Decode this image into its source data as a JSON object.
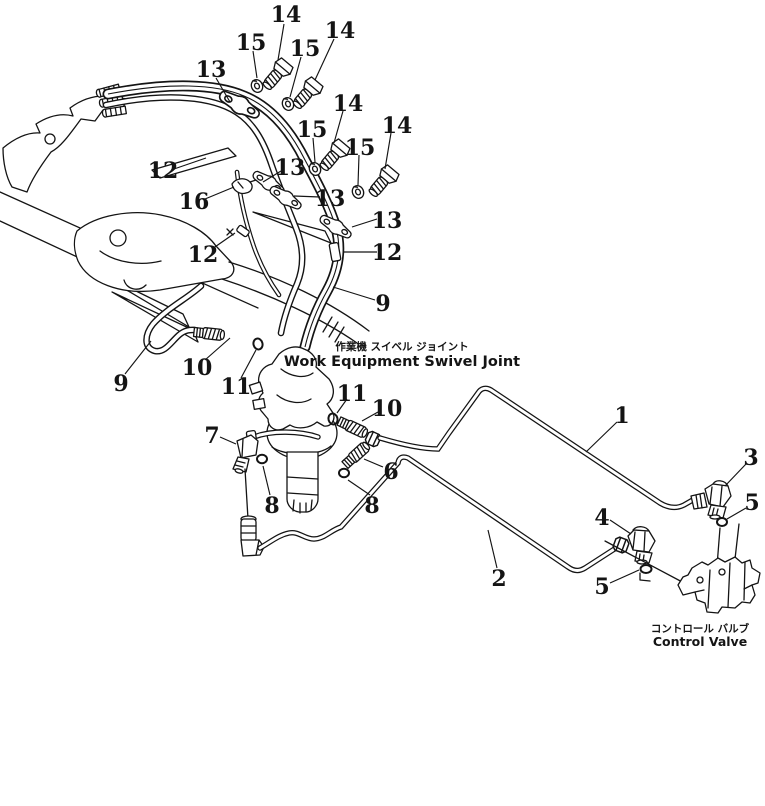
{
  "figure": {
    "kind": "parts-diagram",
    "ink": "#141414",
    "paper": "#ffffff",
    "swivel_caption": {
      "jp": "作業機 スイベル ジョイント",
      "en": "Work Equipment Swivel Joint"
    },
    "valve_caption": {
      "jp": "コントロール バルブ",
      "en": "Control Valve"
    }
  },
  "callouts": [
    {
      "t": "14",
      "x": 286,
      "y": 14,
      "l": [
        284,
        24,
        278,
        60
      ]
    },
    {
      "t": "15",
      "x": 251,
      "y": 42,
      "l": [
        253,
        51,
        257,
        78
      ]
    },
    {
      "t": "15",
      "x": 305,
      "y": 48,
      "l": [
        301,
        57,
        290,
        97
      ]
    },
    {
      "t": "14",
      "x": 340,
      "y": 30,
      "l": [
        334,
        39,
        315,
        80
      ]
    },
    {
      "t": "13",
      "x": 211,
      "y": 69,
      "l": [
        216,
        78,
        230,
        102
      ]
    },
    {
      "t": "14",
      "x": 348,
      "y": 103,
      "l": [
        343,
        111,
        334,
        143
      ]
    },
    {
      "t": "15",
      "x": 312,
      "y": 129,
      "l": [
        313,
        138,
        315,
        162
      ]
    },
    {
      "t": "13",
      "x": 290,
      "y": 167,
      "l": [
        281,
        171,
        263,
        182
      ]
    },
    {
      "t": "15",
      "x": 360,
      "y": 147,
      "l": [
        359,
        155,
        358,
        185
      ]
    },
    {
      "t": "14",
      "x": 397,
      "y": 125,
      "l": [
        391,
        133,
        385,
        169
      ]
    },
    {
      "t": "12",
      "x": 163,
      "y": 170,
      "l": [
        174,
        169,
        206,
        158
      ]
    },
    {
      "t": "16",
      "x": 194,
      "y": 201,
      "l": [
        205,
        199,
        234,
        187
      ]
    },
    {
      "t": "13",
      "x": 330,
      "y": 198,
      "l": [
        320,
        197,
        294,
        196
      ]
    },
    {
      "t": "12",
      "x": 203,
      "y": 254,
      "l": [
        212,
        249,
        235,
        233
      ]
    },
    {
      "t": "13",
      "x": 387,
      "y": 220,
      "l": [
        377,
        219,
        352,
        227
      ]
    },
    {
      "t": "12",
      "x": 387,
      "y": 252,
      "l": [
        377,
        252,
        344,
        252
      ]
    },
    {
      "t": "9",
      "x": 383,
      "y": 303,
      "l": [
        375,
        300,
        333,
        287
      ]
    },
    {
      "t": "9",
      "x": 121,
      "y": 383,
      "l": [
        125,
        374,
        151,
        341
      ]
    },
    {
      "t": "10",
      "x": 197,
      "y": 367,
      "l": [
        205,
        360,
        230,
        338
      ]
    },
    {
      "t": "11",
      "x": 236,
      "y": 386,
      "l": [
        241,
        378,
        256,
        350
      ]
    },
    {
      "t": "11",
      "x": 352,
      "y": 393,
      "l": [
        347,
        399,
        337,
        413
      ]
    },
    {
      "t": "10",
      "x": 387,
      "y": 408,
      "l": [
        378,
        412,
        362,
        421
      ]
    },
    {
      "t": "7",
      "x": 212,
      "y": 435,
      "l": [
        220,
        437,
        236,
        444
      ]
    },
    {
      "t": "8",
      "x": 272,
      "y": 505,
      "l": [
        270,
        495,
        263,
        466
      ]
    },
    {
      "t": "8",
      "x": 372,
      "y": 505,
      "l": [
        370,
        495,
        348,
        480
      ]
    },
    {
      "t": "6",
      "x": 391,
      "y": 471,
      "l": [
        383,
        467,
        364,
        459
      ]
    },
    {
      "t": "1",
      "x": 622,
      "y": 415,
      "l": [
        617,
        422,
        586,
        452
      ]
    },
    {
      "t": "2",
      "x": 499,
      "y": 578,
      "l": [
        497,
        568,
        488,
        530
      ]
    },
    {
      "t": "3",
      "x": 751,
      "y": 457,
      "l": [
        746,
        464,
        725,
        486
      ]
    },
    {
      "t": "5",
      "x": 752,
      "y": 502,
      "l": [
        746,
        508,
        727,
        519
      ]
    },
    {
      "t": "4",
      "x": 602,
      "y": 517,
      "l": [
        610,
        520,
        631,
        534
      ]
    },
    {
      "t": "5",
      "x": 602,
      "y": 586,
      "l": [
        610,
        583,
        639,
        570
      ]
    }
  ]
}
